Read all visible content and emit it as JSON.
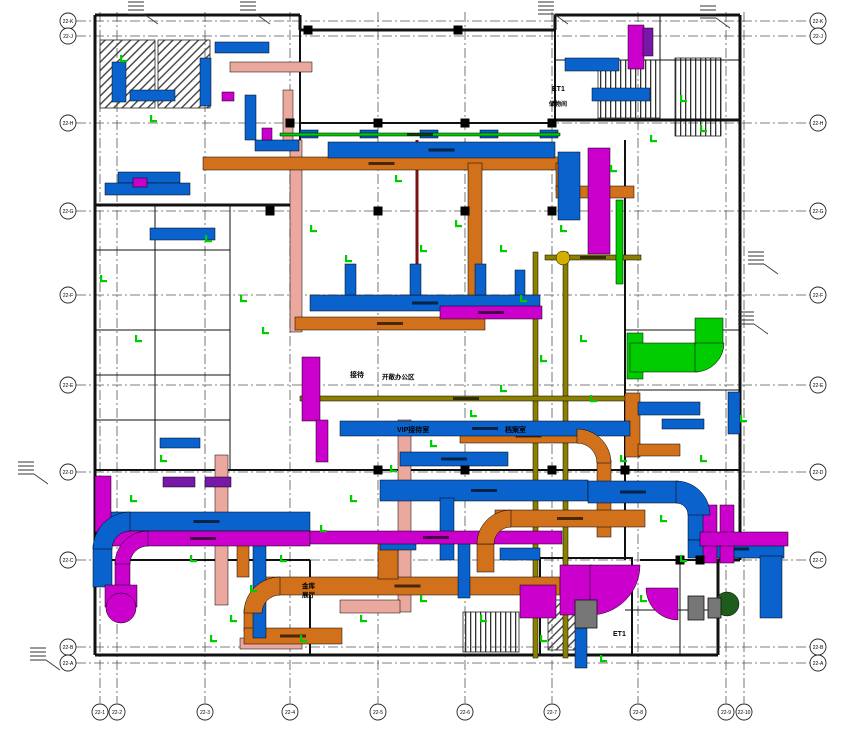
{
  "drawing": {
    "type": "HVAC duct-work floor plan (CAD screenshot)",
    "colors": {
      "supply_blue": "#0a63cc",
      "exhaust_magenta": "#cc00cc",
      "smoke_orange": "#d2711c",
      "fresh_green": "#00cc00",
      "pipe_pink": "#eaa89e",
      "tray_olive": "#8b8000",
      "riser_purple": "#7718a8",
      "firewall_darkred": "#7a1212",
      "wall_black": "#111111",
      "grid_gray": "#555555"
    },
    "grid": {
      "rows": [
        {
          "label": "22-K",
          "y": 21
        },
        {
          "label": "22-J",
          "y": 36
        },
        {
          "label": "22-H",
          "y": 123
        },
        {
          "label": "22-G",
          "y": 211
        },
        {
          "label": "22-F",
          "y": 295
        },
        {
          "label": "22-E",
          "y": 385
        },
        {
          "label": "22-D",
          "y": 472
        },
        {
          "label": "22-C",
          "y": 560
        },
        {
          "label": "22-B",
          "y": 647
        },
        {
          "label": "22-A",
          "y": 663
        }
      ],
      "cols": [
        {
          "label": "22-1",
          "x": 100
        },
        {
          "label": "22-2",
          "x": 117
        },
        {
          "label": "22-3",
          "x": 205
        },
        {
          "label": "22-4",
          "x": 290
        },
        {
          "label": "22-5",
          "x": 378
        },
        {
          "label": "22-6",
          "x": 465
        },
        {
          "label": "22-7",
          "x": 552
        },
        {
          "label": "22-8",
          "x": 638
        },
        {
          "label": "22-9",
          "x": 726
        },
        {
          "label": "22-10",
          "x": 744
        }
      ]
    },
    "rooms": [
      {
        "t": "接待",
        "x": 350,
        "y": 377,
        "s": 7
      },
      {
        "t": "开敞办公区",
        "x": 382,
        "y": 379,
        "s": 6.5
      },
      {
        "t": "VIP接待室",
        "x": 397,
        "y": 432,
        "s": 7
      },
      {
        "t": "档案室",
        "x": 505,
        "y": 432,
        "s": 7
      },
      {
        "t": "金库",
        "x": 302,
        "y": 588,
        "s": 6.5
      },
      {
        "t": "展厅",
        "x": 302,
        "y": 597,
        "s": 6.5
      },
      {
        "t": "ET1",
        "x": 552,
        "y": 91,
        "s": 7
      },
      {
        "t": "储物间",
        "x": 549,
        "y": 106,
        "s": 6
      },
      {
        "t": "ET1",
        "x": 613,
        "y": 636,
        "s": 7
      }
    ]
  },
  "geometry": {
    "walls": [
      [
        95,
        15,
        300,
        15,
        3
      ],
      [
        300,
        15,
        300,
        30,
        3
      ],
      [
        300,
        30,
        555,
        30,
        3
      ],
      [
        555,
        15,
        555,
        30,
        3
      ],
      [
        555,
        15,
        740,
        15,
        3
      ],
      [
        740,
        15,
        740,
        560,
        3
      ],
      [
        740,
        560,
        718,
        560,
        3
      ],
      [
        718,
        560,
        718,
        655,
        3
      ],
      [
        718,
        655,
        95,
        655,
        3
      ],
      [
        95,
        655,
        95,
        15,
        3
      ],
      [
        95,
        205,
        300,
        205,
        3
      ],
      [
        300,
        30,
        300,
        205,
        2
      ],
      [
        555,
        120,
        740,
        120,
        3
      ],
      [
        300,
        123,
        555,
        123,
        2
      ],
      [
        555,
        30,
        555,
        120,
        2
      ],
      [
        95,
        470,
        740,
        470,
        2
      ],
      [
        95,
        560,
        310,
        560,
        2
      ],
      [
        640,
        560,
        740,
        560,
        2
      ],
      [
        310,
        560,
        310,
        655,
        2
      ],
      [
        625,
        140,
        625,
        560,
        2
      ],
      [
        95,
        330,
        230,
        330,
        1
      ],
      [
        95,
        250,
        230,
        250,
        1
      ],
      [
        95,
        375,
        230,
        375,
        1
      ],
      [
        95,
        420,
        230,
        420,
        1
      ],
      [
        155,
        205,
        155,
        470,
        1
      ],
      [
        230,
        205,
        230,
        470,
        1
      ],
      [
        660,
        15,
        660,
        120,
        1
      ],
      [
        555,
        60,
        740,
        60,
        1
      ],
      [
        625,
        390,
        740,
        390,
        1
      ],
      [
        625,
        330,
        740,
        330,
        1
      ],
      [
        680,
        560,
        680,
        655,
        1
      ],
      [
        625,
        610,
        718,
        610,
        1
      ]
    ],
    "columns": [
      [
        308,
        30
      ],
      [
        458,
        30
      ],
      [
        290,
        123
      ],
      [
        378,
        123
      ],
      [
        465,
        123
      ],
      [
        552,
        123
      ],
      [
        270,
        211
      ],
      [
        378,
        211
      ],
      [
        465,
        211
      ],
      [
        552,
        211
      ],
      [
        378,
        470
      ],
      [
        465,
        470
      ],
      [
        552,
        470
      ],
      [
        625,
        470
      ],
      [
        680,
        560
      ],
      [
        700,
        560
      ]
    ],
    "ducts": {
      "pink": [
        [
          290,
          140,
          12,
          192
        ],
        [
          230,
          62,
          82,
          10
        ],
        [
          283,
          90,
          10,
          52
        ],
        [
          398,
          420,
          13,
          192
        ],
        [
          340,
          600,
          60,
          13
        ],
        [
          240,
          638,
          62,
          11
        ],
        [
          215,
          455,
          13,
          150
        ]
      ],
      "orange": [
        [
          203,
          157,
          357,
          13
        ],
        [
          468,
          163,
          14,
          155
        ],
        [
          295,
          317,
          190,
          13
        ],
        [
          556,
          163,
          13,
          28
        ],
        [
          556,
          186,
          78,
          12
        ],
        [
          460,
          429,
          137,
          14
        ],
        [
          597,
          460,
          14,
          77
        ],
        [
          495,
          510,
          150,
          17
        ],
        [
          477,
          540,
          17,
          32
        ],
        [
          255,
          577,
          305,
          18
        ],
        [
          244,
          609,
          18,
          22
        ],
        [
          244,
          628,
          98,
          16
        ],
        [
          378,
          543,
          20,
          36
        ],
        [
          625,
          393,
          15,
          64
        ],
        [
          638,
          444,
          42,
          12
        ],
        [
          237,
          545,
          12,
          32
        ]
      ],
      "blue": [
        [
          328,
          142,
          227,
          16
        ],
        [
          558,
          152,
          22,
          68
        ],
        [
          310,
          295,
          230,
          16
        ],
        [
          345,
          264,
          11,
          31
        ],
        [
          410,
          264,
          11,
          31
        ],
        [
          475,
          264,
          11,
          31
        ],
        [
          515,
          270,
          10,
          25
        ],
        [
          340,
          421,
          290,
          15
        ],
        [
          400,
          452,
          108,
          14
        ],
        [
          380,
          480,
          208,
          21
        ],
        [
          588,
          481,
          90,
          22
        ],
        [
          103,
          512,
          207,
          19
        ],
        [
          93,
          545,
          19,
          42
        ],
        [
          253,
          538,
          13,
          100
        ],
        [
          440,
          498,
          14,
          62
        ],
        [
          458,
          540,
          12,
          58
        ],
        [
          380,
          538,
          36,
          12
        ],
        [
          565,
          58,
          54,
          13
        ],
        [
          592,
          88,
          58,
          13
        ],
        [
          638,
          402,
          62,
          13
        ],
        [
          662,
          419,
          42,
          10
        ],
        [
          728,
          392,
          12,
          42
        ],
        [
          112,
          62,
          14,
          40
        ],
        [
          130,
          90,
          45,
          11
        ],
        [
          118,
          172,
          62,
          11
        ],
        [
          200,
          58,
          11,
          48
        ],
        [
          215,
          42,
          54,
          11
        ],
        [
          245,
          95,
          11,
          45
        ],
        [
          255,
          140,
          44,
          11
        ],
        [
          105,
          183,
          85,
          12
        ],
        [
          150,
          228,
          65,
          12
        ],
        [
          640,
          348,
          12,
          22
        ],
        [
          662,
          348,
          10,
          22
        ],
        [
          688,
          512,
          22,
          28
        ],
        [
          688,
          540,
          96,
          18
        ],
        [
          760,
          556,
          22,
          62
        ],
        [
          575,
          628,
          12,
          40
        ],
        [
          500,
          548,
          40,
          12
        ],
        [
          160,
          438,
          40,
          10
        ],
        [
          300,
          130,
          18,
          8
        ],
        [
          360,
          130,
          18,
          8
        ],
        [
          420,
          130,
          18,
          8
        ],
        [
          480,
          130,
          18,
          8
        ],
        [
          540,
          130,
          18,
          8
        ]
      ],
      "magenta": [
        [
          588,
          148,
          22,
          106
        ],
        [
          96,
          531,
          214,
          15
        ],
        [
          310,
          531,
          252,
          13
        ],
        [
          115,
          560,
          15,
          28
        ],
        [
          105,
          585,
          32,
          22
        ],
        [
          302,
          357,
          18,
          64
        ],
        [
          316,
          420,
          12,
          42
        ],
        [
          440,
          306,
          102,
          13
        ],
        [
          560,
          565,
          32,
          50
        ],
        [
          520,
          585,
          36,
          33
        ],
        [
          628,
          25,
          16,
          44
        ],
        [
          133,
          178,
          14,
          9
        ],
        [
          222,
          92,
          12,
          9
        ],
        [
          262,
          128,
          10,
          12
        ],
        [
          703,
          505,
          14,
          58
        ],
        [
          720,
          505,
          14,
          58
        ],
        [
          700,
          532,
          88,
          14
        ],
        [
          95,
          476,
          16,
          56
        ]
      ],
      "green": [
        [
          627,
          333,
          16,
          46
        ],
        [
          630,
          343,
          68,
          29
        ],
        [
          695,
          318,
          28,
          28
        ],
        [
          616,
          200,
          7,
          84
        ],
        [
          280,
          133,
          280,
          3
        ]
      ],
      "olive": [
        [
          533,
          252,
          5,
          406
        ],
        [
          563,
          252,
          5,
          406
        ],
        [
          545,
          255,
          96,
          5
        ],
        [
          300,
          396,
          332,
          5
        ]
      ],
      "purple": [
        [
          643,
          28,
          10,
          28
        ],
        [
          163,
          477,
          32,
          10
        ],
        [
          205,
          477,
          26,
          10
        ]
      ]
    },
    "elbows": [
      {
        "c": "blue",
        "q": "tl",
        "cx": 130,
        "cy": 549,
        "ro": 37,
        "t": 19
      },
      {
        "c": "magenta",
        "q": "tl",
        "cx": 148,
        "cy": 564,
        "ro": 33,
        "t": 15
      },
      {
        "c": "orange",
        "q": "tr",
        "cx": 577,
        "cy": 463,
        "ro": 34,
        "t": 14
      },
      {
        "c": "orange",
        "q": "tl",
        "cx": 511,
        "cy": 544,
        "ro": 34,
        "t": 17
      },
      {
        "c": "orange",
        "q": "tl",
        "cx": 280,
        "cy": 613,
        "ro": 36,
        "t": 18
      },
      {
        "c": "blue",
        "q": "tr",
        "cx": 676,
        "cy": 515,
        "ro": 34,
        "t": 22
      },
      {
        "c": "green",
        "q": "br",
        "cx": 695,
        "cy": 343,
        "ro": 29,
        "t": 29
      },
      {
        "c": "magenta",
        "q": "br",
        "cx": 590,
        "cy": 565,
        "ro": 50,
        "t": 50
      },
      {
        "c": "magenta",
        "q": "bl",
        "cx": 678,
        "cy": 588,
        "ro": 32,
        "t": 32
      }
    ],
    "circles": [
      {
        "c": "magenta",
        "cx": 121,
        "cy": 608,
        "r": 15
      },
      {
        "c": "#d4af00",
        "cx": 563,
        "cy": 258,
        "r": 7
      },
      {
        "c": "#1d5c1d",
        "cx": 727,
        "cy": 604,
        "r": 12
      }
    ],
    "darkred_line": [
      417,
      140,
      417,
      282,
      3
    ],
    "hatch_diag": [
      [
        100,
        40,
        55,
        68
      ],
      [
        158,
        40,
        52,
        68
      ],
      [
        548,
        600,
        36,
        50
      ]
    ],
    "hatch_vert": [
      [
        598,
        60,
        62,
        58
      ],
      [
        675,
        58,
        46,
        78
      ],
      [
        463,
        612,
        56,
        40
      ]
    ],
    "shaft": [
      540,
      558,
      92,
      97
    ],
    "equipment": [
      [
        688,
        596,
        16,
        24
      ],
      [
        708,
        598,
        13,
        20
      ],
      [
        575,
        600,
        22,
        28
      ]
    ],
    "leaders": [
      [
        128,
        2
      ],
      [
        240,
        2
      ],
      [
        538,
        2
      ],
      [
        700,
        6
      ],
      [
        30,
        648
      ],
      [
        748,
        252
      ],
      [
        738,
        312
      ],
      [
        18,
        462
      ]
    ],
    "green_marks": [
      [
        120,
        60
      ],
      [
        150,
        120
      ],
      [
        205,
        240
      ],
      [
        240,
        300
      ],
      [
        262,
        332
      ],
      [
        310,
        230
      ],
      [
        345,
        260
      ],
      [
        395,
        180
      ],
      [
        420,
        250
      ],
      [
        455,
        225
      ],
      [
        500,
        250
      ],
      [
        520,
        300
      ],
      [
        560,
        230
      ],
      [
        610,
        170
      ],
      [
        650,
        140
      ],
      [
        680,
        100
      ],
      [
        700,
        130
      ],
      [
        580,
        340
      ],
      [
        540,
        360
      ],
      [
        500,
        390
      ],
      [
        470,
        415
      ],
      [
        430,
        445
      ],
      [
        390,
        470
      ],
      [
        350,
        500
      ],
      [
        320,
        530
      ],
      [
        280,
        560
      ],
      [
        250,
        590
      ],
      [
        230,
        620
      ],
      [
        300,
        640
      ],
      [
        360,
        620
      ],
      [
        420,
        600
      ],
      [
        480,
        620
      ],
      [
        540,
        640
      ],
      [
        600,
        660
      ],
      [
        640,
        600
      ],
      [
        680,
        560
      ],
      [
        700,
        460
      ],
      [
        740,
        420
      ],
      [
        160,
        460
      ],
      [
        130,
        500
      ],
      [
        190,
        560
      ],
      [
        210,
        640
      ],
      [
        590,
        400
      ],
      [
        620,
        460
      ],
      [
        660,
        520
      ],
      [
        100,
        280
      ],
      [
        135,
        340
      ]
    ]
  }
}
